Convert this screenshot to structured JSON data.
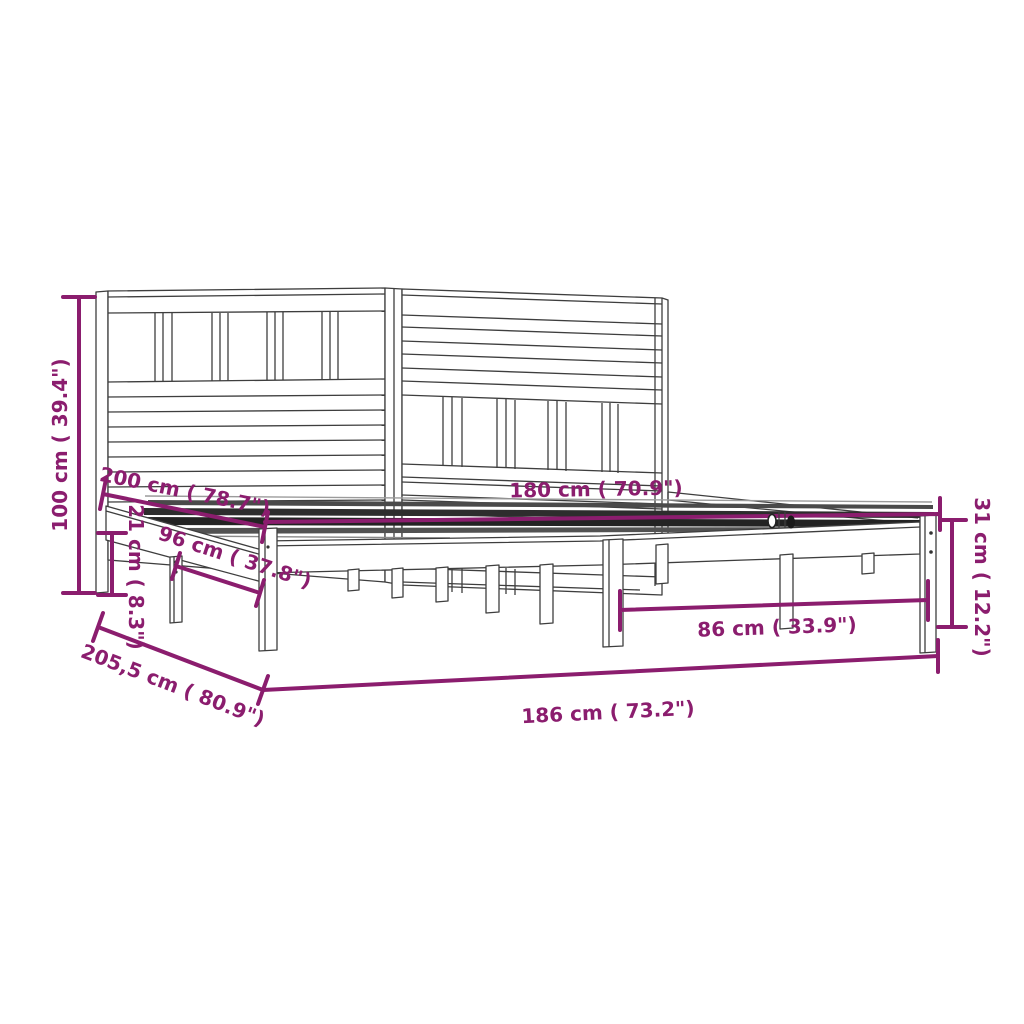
{
  "diagram": {
    "kind": "product-dimension-drawing",
    "product": "wooden bed frame with slatted headboard (two joined slatted bases)",
    "background_color": "#ffffff",
    "line_color": "#3e3e3e",
    "accent_color": "#8b1d6e",
    "dimensions": [
      {
        "id": "total-height",
        "label": "100 cm ( 39.4\")",
        "orientation": "vertical-left"
      },
      {
        "id": "frame-length",
        "label": "200 cm ( 78.7\")",
        "orientation": "diagonal"
      },
      {
        "id": "mattress-width",
        "label": "180 cm ( 70.9\")",
        "orientation": "horizontal"
      },
      {
        "id": "side-rail-height",
        "label": "21 cm ( 8.3\")",
        "orientation": "vertical-left"
      },
      {
        "id": "single-base-width",
        "label": "96 cm ( 37.8\")",
        "orientation": "diagonal"
      },
      {
        "id": "leg-span-width",
        "label": "86 cm ( 33.9\")",
        "orientation": "horizontal"
      },
      {
        "id": "foot-end-height",
        "label": "31 cm ( 12.2\")",
        "orientation": "vertical-right"
      },
      {
        "id": "total-length",
        "label": "205,5 cm ( 80.9\")",
        "orientation": "diagonal"
      },
      {
        "id": "total-width",
        "label": "186 cm ( 73.2\")",
        "orientation": "horizontal"
      }
    ]
  }
}
